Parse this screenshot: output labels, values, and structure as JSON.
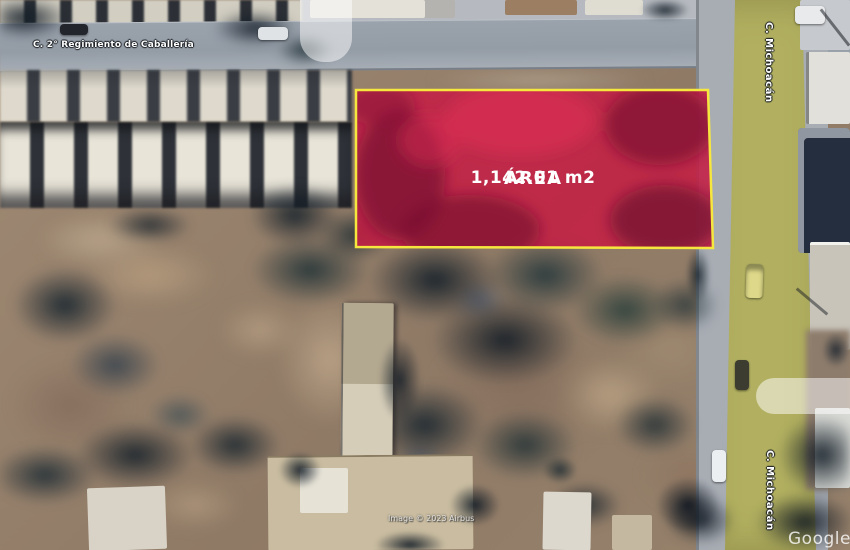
{
  "map": {
    "street_label_top": "C. 2° Regimiento de Caballería",
    "street_label_right_top": "C. Michoacán",
    "street_label_right_bottom": "C. Michoacán",
    "attribution": "Image © 2023 Airbus",
    "watermark": "Google Earth"
  },
  "parcel": {
    "title": "ÁREA",
    "area": "1,142.01 m2",
    "fill_color": "#c41f44",
    "border_color": "#f6e73e",
    "text_color": "#ffffff"
  },
  "colors": {
    "road_gray": "#9aa2ac",
    "road_olive": "#b2b060",
    "dirt_base": "#9b8672",
    "tree_dark": "#16222e"
  }
}
